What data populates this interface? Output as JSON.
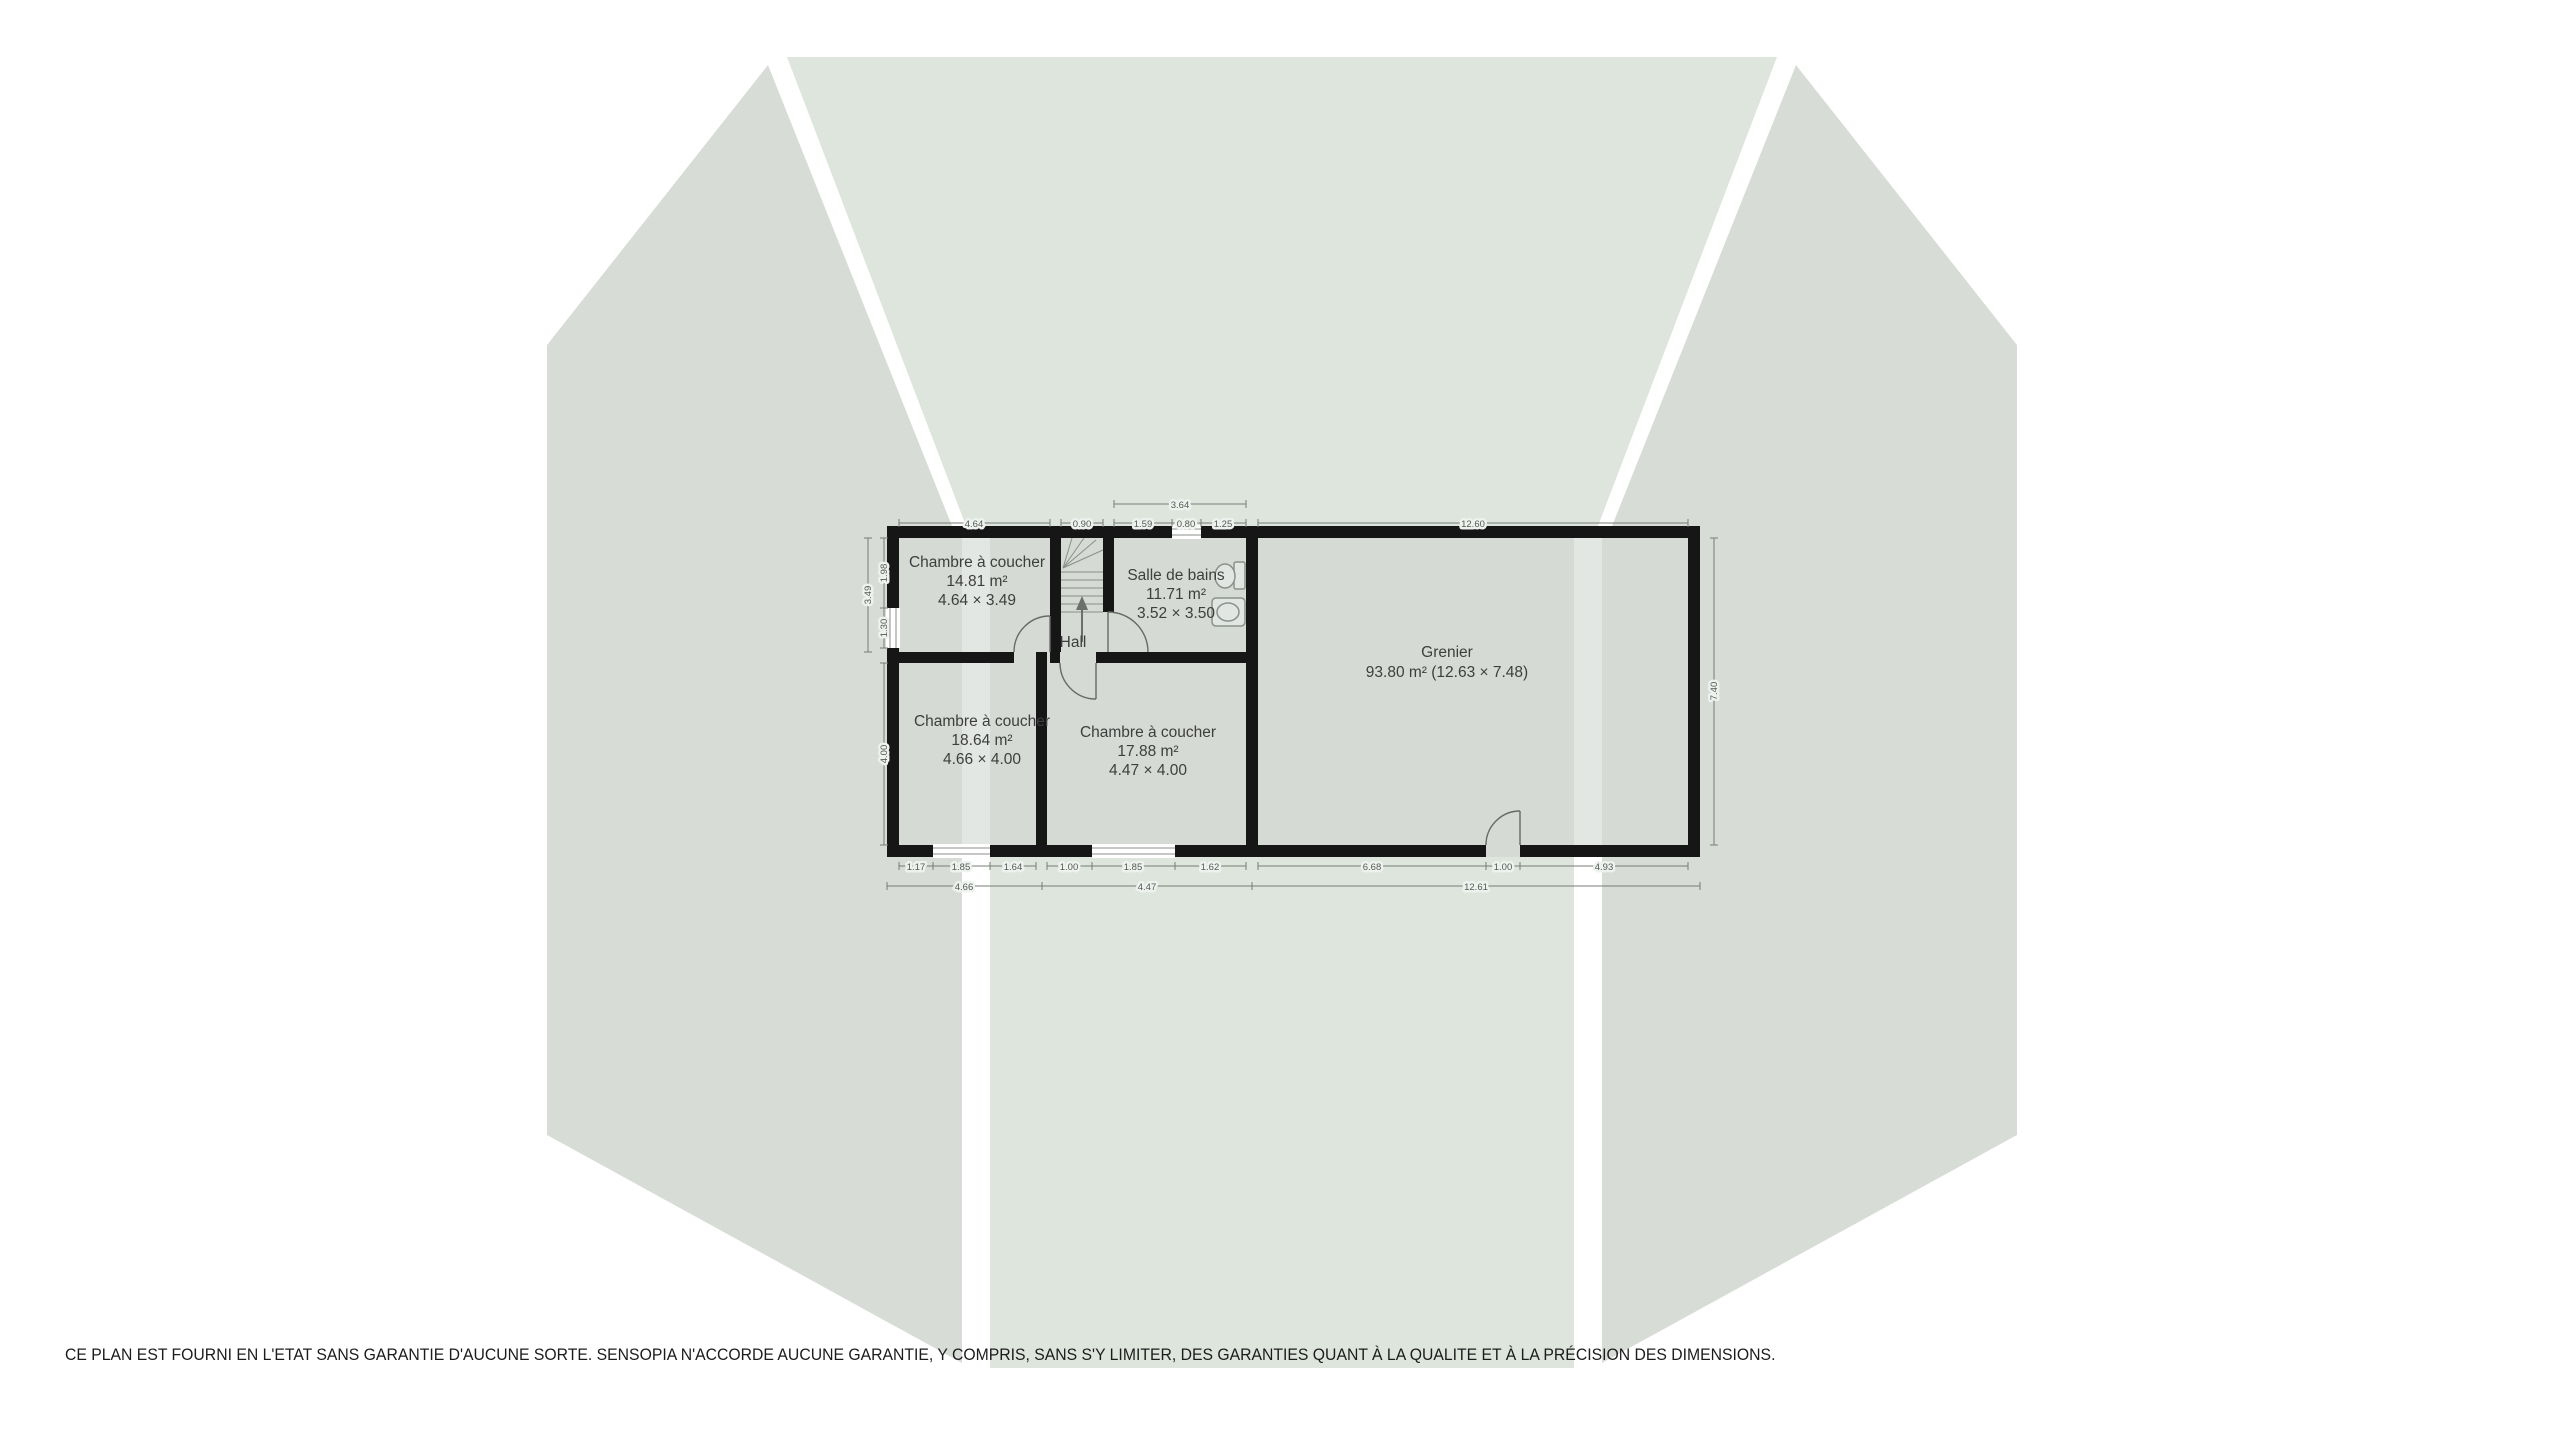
{
  "plan": {
    "rooms": {
      "bedroom_top": {
        "name": "Chambre à coucher",
        "area": "14.81 m²",
        "size": "4.64 × 3.49"
      },
      "bathroom": {
        "name": "Salle de bains",
        "area": "11.71 m²",
        "size": "3.52 × 3.50"
      },
      "hall": {
        "name": "Hall"
      },
      "bedroom_bottom_left": {
        "name": "Chambre à coucher",
        "area": "18.64 m²",
        "size": "4.66 × 4.00"
      },
      "bedroom_bottom_mid": {
        "name": "Chambre à coucher",
        "area": "17.88 m²",
        "size": "4.47 × 4.00"
      },
      "attic": {
        "name": "Grenier",
        "area": "93.80 m² (12.63 × 7.48)"
      }
    },
    "dims": {
      "top": [
        "4.64",
        "0.90",
        "1.59",
        "0.80",
        "1.25",
        "12.60"
      ],
      "bath_width": "3.64",
      "bottom_inner": [
        "1.17",
        "1.85",
        "1.64",
        "1.00",
        "1.85",
        "1.62",
        "6.68",
        "1.00",
        "4.93"
      ],
      "bottom_outer": [
        "4.66",
        "4.47",
        "12.61"
      ],
      "left_inner": [
        "1.98",
        "1.30"
      ],
      "left_outer": "3.49",
      "left_lower": "4.00",
      "right": "7.40"
    }
  },
  "footer": {
    "disclaimer": "CE PLAN EST FOURNI EN L'ETAT SANS GARANTIE D'AUCUNE SORTE. SENSOPIA N'ACCORDE AUCUNE GARANTIE, Y COMPRIS, SANS S'Y LIMITER, DES GARANTIES QUANT À LA QUALITE ET À LA PRÉCISION DES DIMENSIONS."
  },
  "colors": {
    "background": "#ffffff",
    "silhouette_side": "#d7ddd6",
    "silhouette_center": "#dee5dd",
    "room_fill": "#d5dad4",
    "wall": "#161616",
    "dimension": "#5f6660",
    "label": "#3e3e3e"
  }
}
